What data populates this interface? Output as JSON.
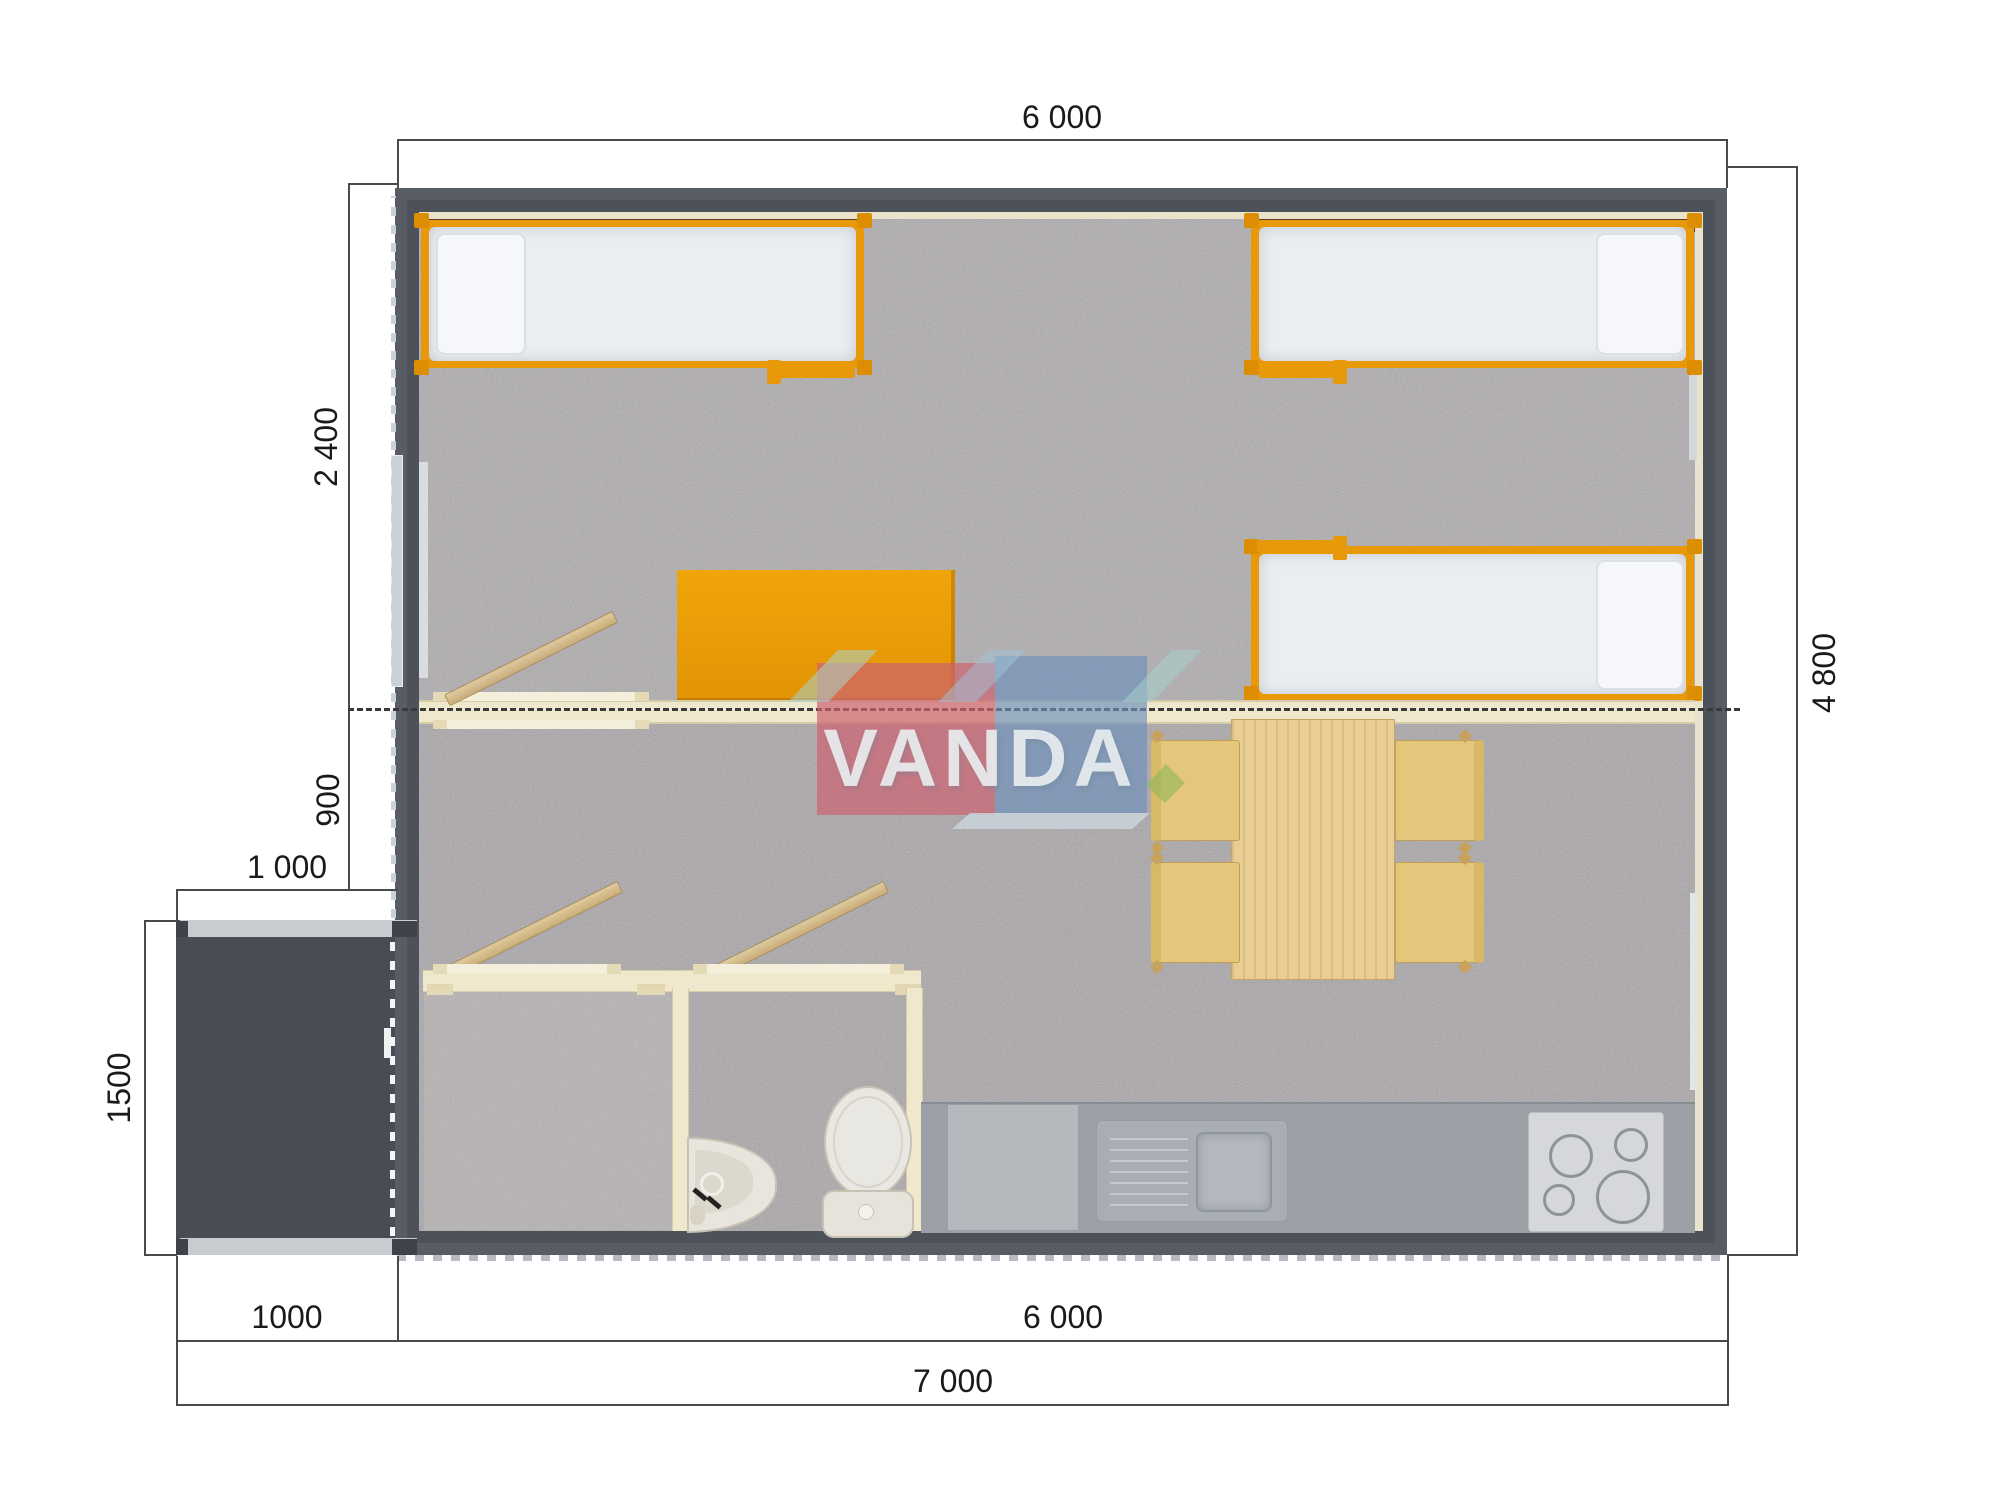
{
  "drawing": {
    "type": "floor-plan-top-view",
    "watermark": {
      "text": "VANDA",
      "pink": "#cd6270",
      "blue": "#6f91b9",
      "teal": "#a8d4cd",
      "green": "#8fb857"
    },
    "dimensions": {
      "top_width": "6 000",
      "left_bedroom_depth": "2 400",
      "left_hall_depth": "900",
      "porch_width": "1 000",
      "porch_depth": "1500",
      "right_height": "4 800",
      "bottom_porch_width": "1000",
      "bottom_main_width": "6 000",
      "bottom_total_width": "7 000"
    },
    "colors": {
      "wall": "#575c65",
      "porch_floor": "#484c55",
      "carpet": "#a9a5a8",
      "interior_wall_cream": "#efe8cc",
      "accent_orange": "#e8990a",
      "mattress_white": "#eaedf1",
      "wood_table": "#e8cd94",
      "chair_yellow": "#e5c77c",
      "kitchen_counter": "#9ca1a7",
      "shelf_brown": "#5d4124"
    },
    "furniture_icons": [
      "single-bed",
      "single-bed",
      "single-bed",
      "wardrobe",
      "fold-bench",
      "lean-plank",
      "dining-table",
      "chair",
      "chair",
      "chair",
      "chair",
      "kitchen-counter",
      "kitchen-sink",
      "stove",
      "appliance-block",
      "washbasin",
      "toilet",
      "porch-door"
    ]
  }
}
